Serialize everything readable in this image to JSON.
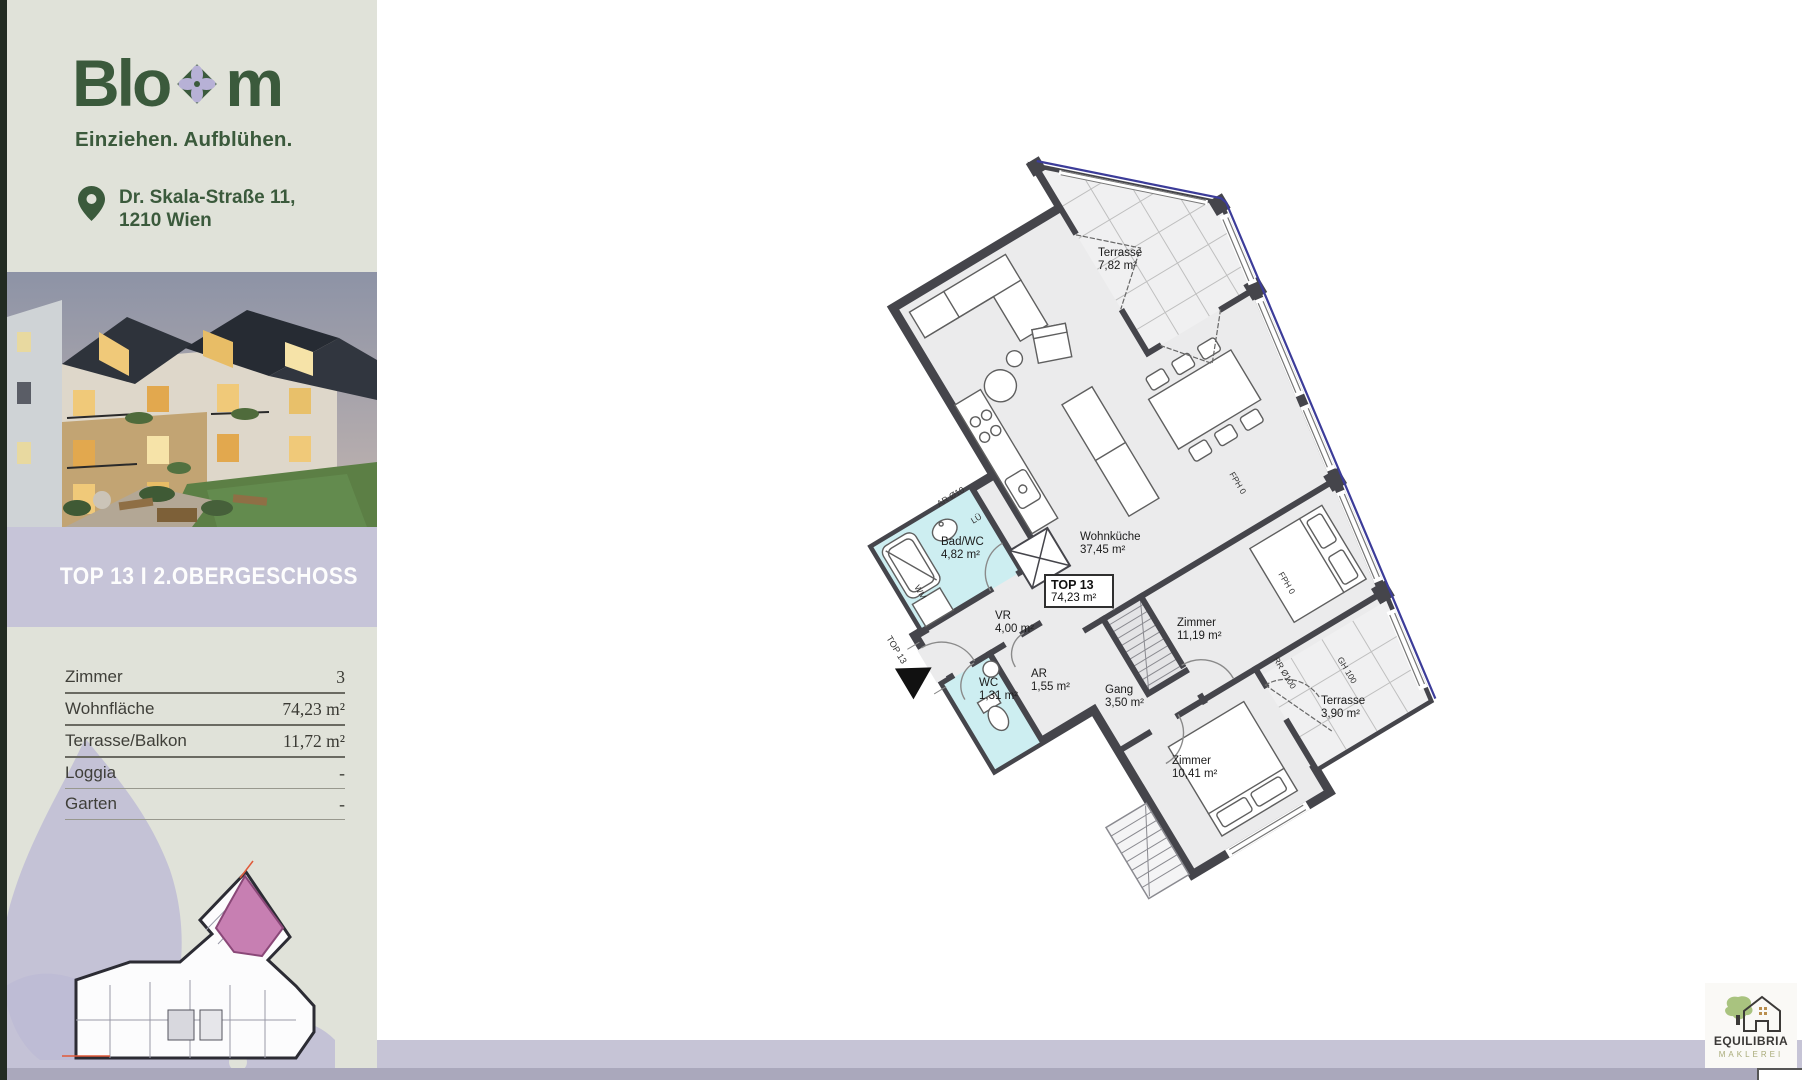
{
  "sidebar": {
    "brand": {
      "pre": "Blo",
      "post": "m",
      "tagline": "Einziehen. Aufblühen."
    },
    "address": {
      "line1": "Dr. Skala-Straße 11,",
      "line2": "1210 Wien"
    },
    "banner": "TOP 13 I 2.OBERGESCHOSS",
    "details": {
      "rows": [
        {
          "label": "Zimmer",
          "value": "3"
        },
        {
          "label": "Wohnfläche",
          "value": "74,23 m²"
        },
        {
          "label": "Terrasse/Balkon",
          "value": "11,72 m²"
        },
        {
          "label": "Loggia",
          "value": "-"
        },
        {
          "label": "Garten",
          "value": "-"
        }
      ]
    }
  },
  "floorplan": {
    "unit": {
      "title": "TOP 13",
      "area": "74,23 m²"
    },
    "rooms": {
      "terrasse_top": {
        "name": "Terrasse",
        "area": "7,82 m²"
      },
      "wohnkueche": {
        "name": "Wohnküche",
        "area": "37,45 m²"
      },
      "bad_wc": {
        "name": "Bad/WC",
        "area": "4,82 m²"
      },
      "vr": {
        "name": "VR",
        "area": "4,00 m²"
      },
      "wc": {
        "name": "WC",
        "area": "1,31 m²"
      },
      "ar": {
        "name": "AR",
        "area": "1,55 m²"
      },
      "gang": {
        "name": "Gang",
        "area": "3,50 m²"
      },
      "zimmer_1": {
        "name": "Zimmer",
        "area": "11,19 m²"
      },
      "zimmer_2": {
        "name": "Zimmer",
        "area": "10,41 m²"
      },
      "terrasse_side": {
        "name": "Terrasse",
        "area": "3,90 m²"
      }
    },
    "annotations": {
      "entrance": "TOP 13",
      "wm": "WM",
      "lue": "LÜ",
      "ar_pipe": "AR Ø10",
      "fph_1": "FPH 0",
      "fph_2": "FPH 0",
      "rr": "RR Ø100",
      "gh": "GH 100"
    }
  },
  "broker": {
    "name": "EQUILIBRIA",
    "subtitle": "MAKLEREI"
  },
  "colors": {
    "brand_green": "#3b5a3c",
    "lavender_banner": "#c6c4d8",
    "sage_bg": "#e0e2d9",
    "unit_pink": "#c77fb2",
    "wall_grey": "#45454b",
    "bath_cyan": "#cdeef1",
    "property_line_blue": "#3c3c99"
  }
}
